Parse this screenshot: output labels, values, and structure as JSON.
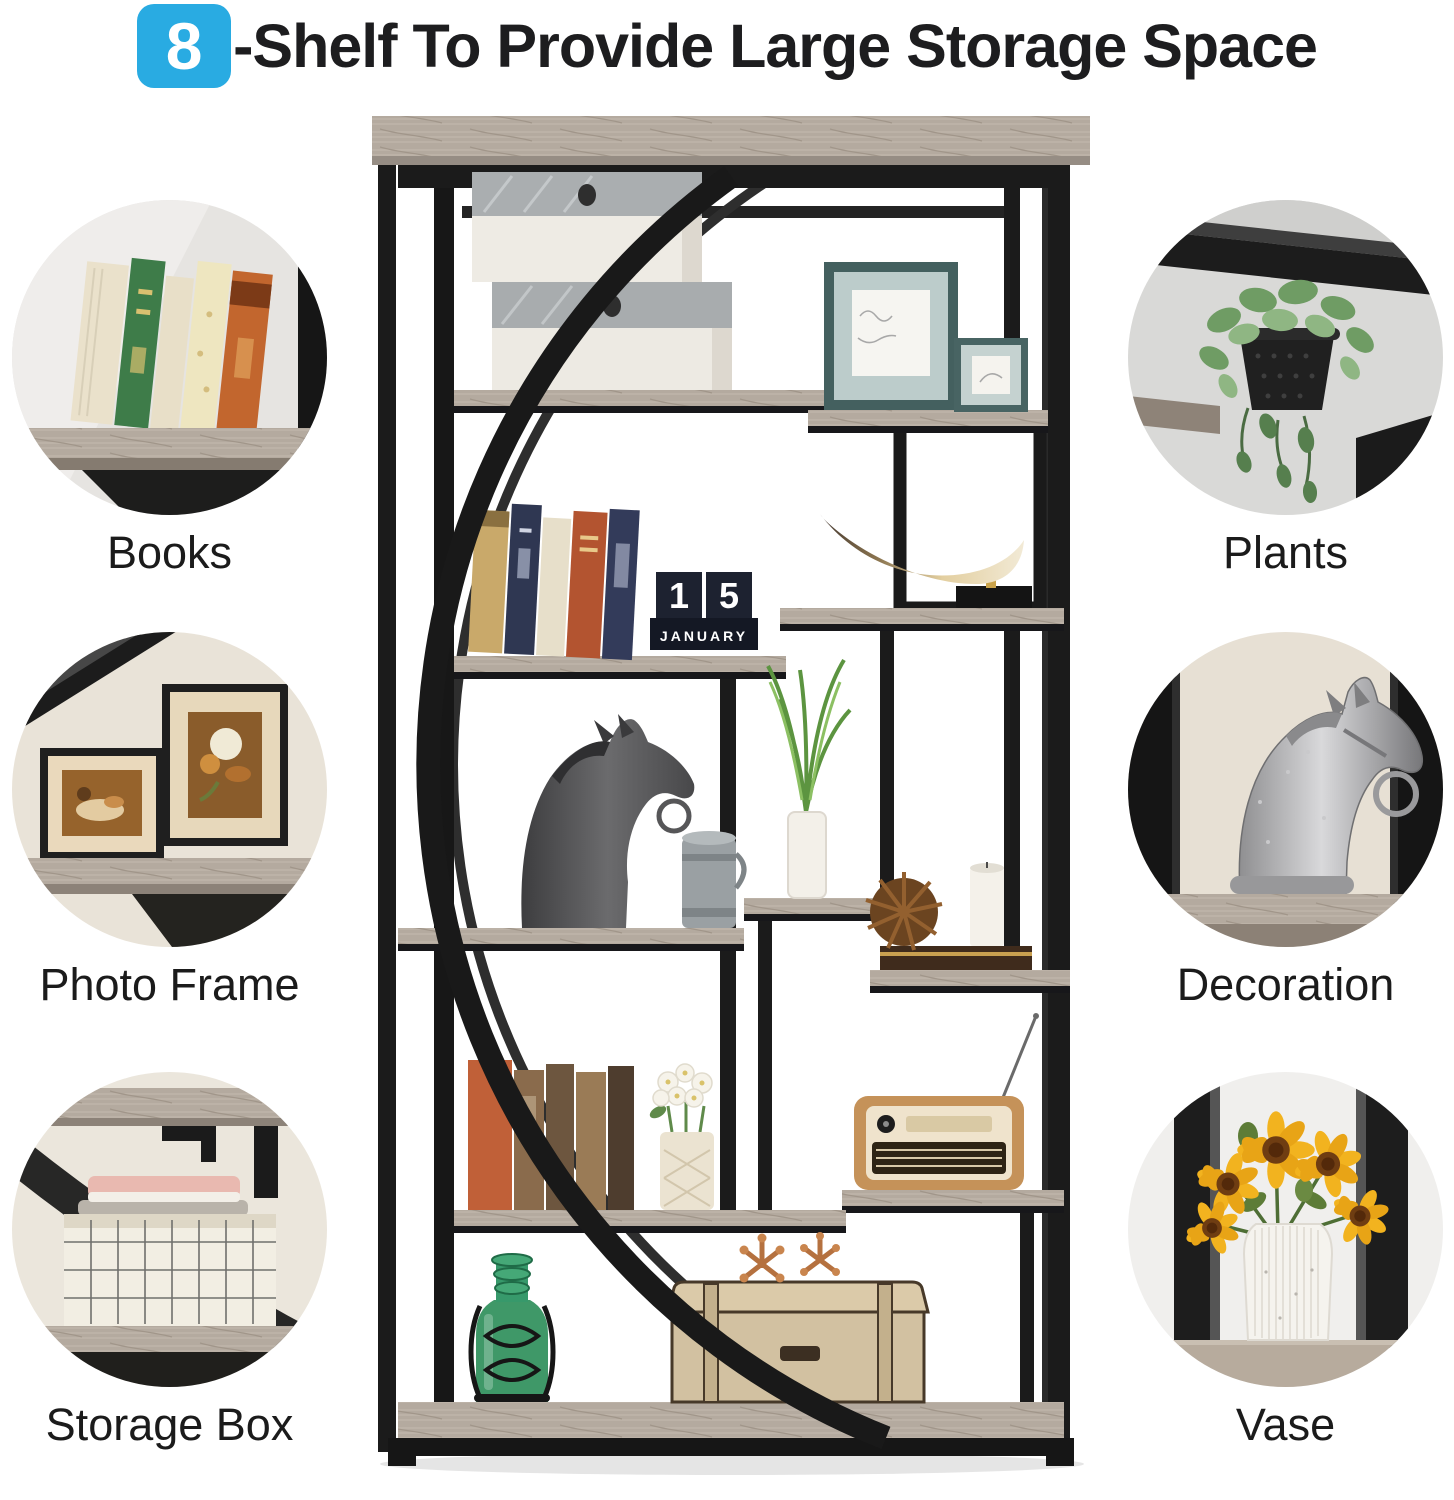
{
  "title": {
    "badge": "8",
    "text": "-Shelf To Provide Large Storage Space"
  },
  "callouts": {
    "left": [
      {
        "id": "books",
        "label": "Books"
      },
      {
        "id": "photo-frame",
        "label": "Photo Frame"
      },
      {
        "id": "storage-box",
        "label": "Storage Box"
      }
    ],
    "right": [
      {
        "id": "plants",
        "label": "Plants"
      },
      {
        "id": "decoration",
        "label": "Decoration"
      },
      {
        "id": "vase",
        "label": "Vase"
      }
    ]
  },
  "product": {
    "calendar": {
      "day_tens": "1",
      "day_ones": "5",
      "month": "JANUARY"
    }
  },
  "colors": {
    "accent": "#29ABE2",
    "title_text": "#1D1D1F",
    "label_text": "#1B1B1B",
    "frame_black": "#1A1A1A",
    "wood_gray": "#B4AA9F",
    "background": "#FFFFFF"
  }
}
